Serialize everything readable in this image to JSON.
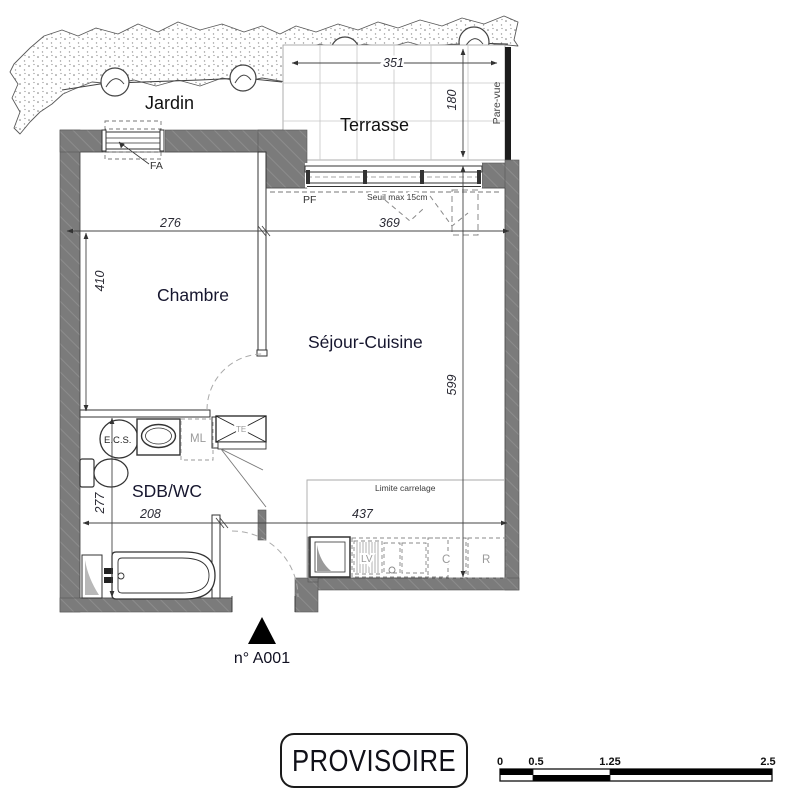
{
  "meta": {
    "stamp": "PROVISOIRE",
    "unit_number": "n° A001"
  },
  "rooms": {
    "jardin": "Jardin",
    "terrasse": "Terrasse",
    "chambre": "Chambre",
    "sejour_cuisine": "Séjour-Cuisine",
    "sdb_wc": "SDB/WC"
  },
  "dimensions_cm": {
    "terrasse_width": "351",
    "terrasse_depth": "180",
    "chambre_width": "276",
    "sejour_width": "369",
    "chambre_length": "410",
    "sejour_length": "599",
    "sdb_width": "208",
    "sdb_length": "277",
    "cuisine_width": "437"
  },
  "annotations": {
    "pare_vue": "Pare-vue",
    "window_fa": "FA",
    "bay_pf": "PF",
    "seuil": "Seuil max 15cm",
    "limite_carrelage": "Limite carrelage",
    "water_heater": "E.C.S.",
    "washing_machine": "ML",
    "technical_box": "TE",
    "dishwasher": "LV",
    "cooker": "C",
    "fridge": "R"
  },
  "scale_bar": {
    "ticks": [
      "0",
      "0.5",
      "1.25",
      "2.5"
    ]
  },
  "colors": {
    "wall": "#7b7b7b",
    "line": "#333333",
    "label": "#16162e",
    "muted": "#9a9a9a"
  }
}
